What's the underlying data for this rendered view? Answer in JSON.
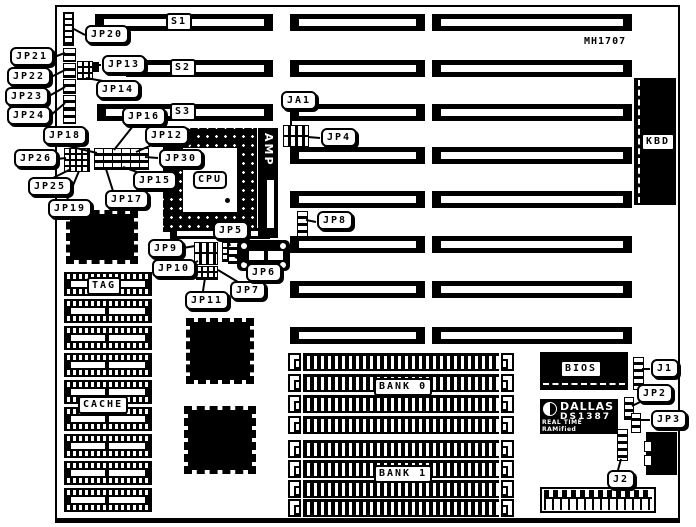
{
  "board": {
    "part_number": "MH1707",
    "ink": "#000000",
    "bg": "#ffffff"
  },
  "components": {
    "s1": "S1",
    "s2": "S2",
    "s3": "S3",
    "cpu": "CPU",
    "amp": "AMP",
    "tag": "TAG",
    "cache": "CACHE",
    "bank0": "BANK 0",
    "bank1": "BANK 1",
    "bios": "BIOS",
    "kbd": "KBD",
    "dallas_brand": "DALLAS",
    "dallas_model": "DS1387",
    "dallas_desc": "REAL TIME RAMified"
  },
  "callouts": {
    "jp20": "JP20",
    "jp21": "JP21",
    "jp22": "JP22",
    "jp23": "JP23",
    "jp24": "JP24",
    "jp13": "JP13",
    "jp14": "JP14",
    "jp16": "JP16",
    "jp12": "JP12",
    "jp18": "JP18",
    "jp26": "JP26",
    "jp30": "JP30",
    "jp25": "JP25",
    "jp15": "JP15",
    "jp17": "JP17",
    "jp19": "JP19",
    "ja1": "JA1",
    "jp4": "JP4",
    "jp8": "JP8",
    "jp5": "JP5",
    "jp9": "JP9",
    "jp10": "JP10",
    "jp11": "JP11",
    "jp7": "JP7",
    "jp6": "JP6",
    "j1": "J1",
    "jp2": "JP2",
    "jp3": "JP3",
    "j2": "J2"
  }
}
